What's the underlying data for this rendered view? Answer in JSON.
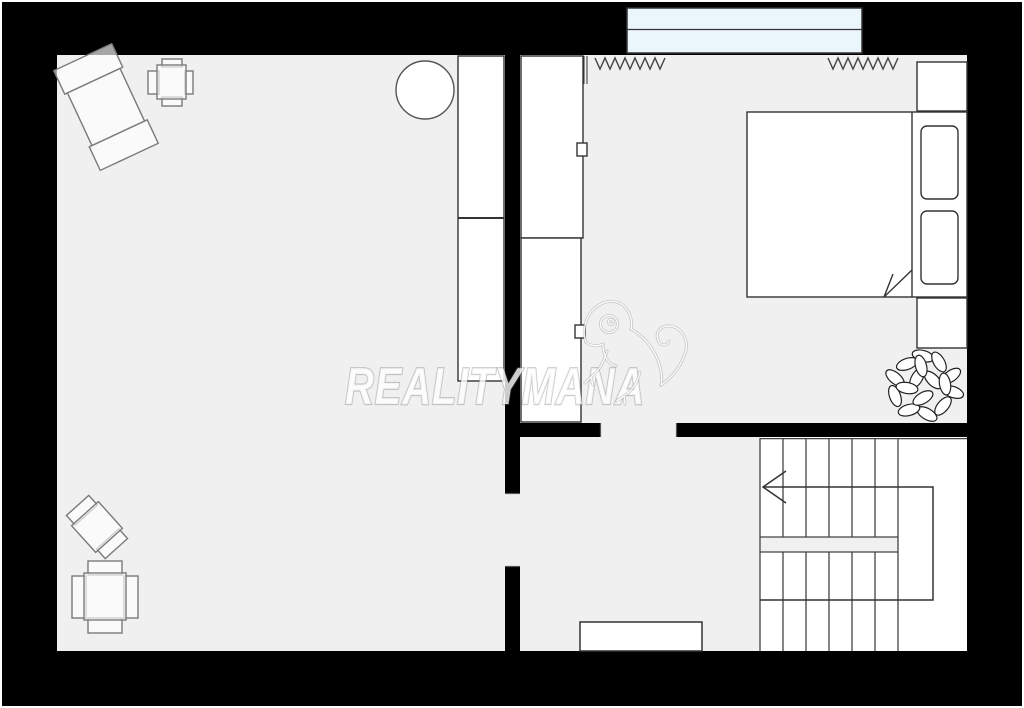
{
  "document": {
    "type": "real-estate floor plan",
    "view": "2D top-down plan, one storey"
  },
  "watermark": {
    "text": "REALITYMANA",
    "logo": "chameleon-outline"
  },
  "colors": {
    "wall": "#000000",
    "room_floor": "#f0f0f0",
    "stair_floor": "#ffffff",
    "furniture_fill": "#ffffff",
    "outline": "#333333",
    "light_outline": "#777777",
    "window_glass": "#eaf5fc",
    "watermark": "#ffffff",
    "image_border": "#ffffff"
  },
  "rooms": [
    {
      "name": "living-room",
      "position": "left",
      "furniture": [
        "rotated-table-with-two-chairs",
        "small-table-with-four-chairs",
        "round-table",
        "wardrobe-two-sections",
        "rotated-chair",
        "table-with-four-chairs"
      ]
    },
    {
      "name": "bedroom",
      "position": "top-right",
      "furniture": [
        "wardrobe-two-sections-with-handles",
        "double-bed",
        "pillow",
        "pillow",
        "nightstand-top",
        "nightstand-bottom",
        "plant"
      ],
      "fixtures": [
        "window",
        "radiator-left",
        "radiator-right",
        "door-opening-to-hallway"
      ]
    },
    {
      "name": "hallway",
      "position": "bottom-middle",
      "furniture": [
        "low-cabinet"
      ],
      "fixtures": [
        "door-opening-to-living-room"
      ]
    },
    {
      "name": "staircase",
      "position": "bottom-right",
      "details": {
        "shape": "U-shaped switchback",
        "flights": 2,
        "treads_per_flight": 6,
        "walking_line_arrow_direction": "left"
      }
    }
  ],
  "fixtures": {
    "window": {
      "panes": 2,
      "glass_color": "#eaf5fc"
    },
    "radiators": 2
  }
}
